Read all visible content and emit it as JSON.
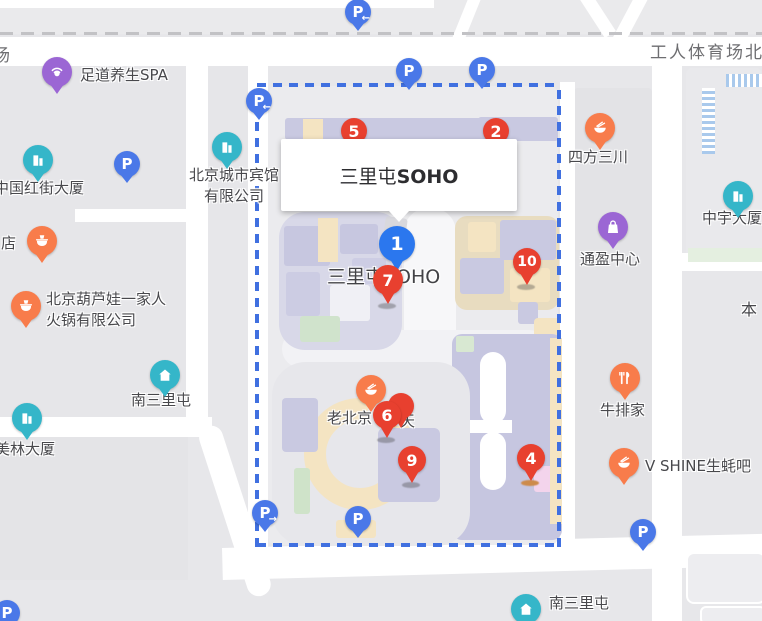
{
  "card": {
    "title_cjk": "三里屯",
    "title_latin": "SOHO"
  },
  "boundary": {
    "style": "dashed",
    "color": "#4070e0"
  },
  "map_text_labels": [
    {
      "id": "map-label-sanlitun-soho",
      "text": "三里屯SOHO",
      "x": 327,
      "y": 266,
      "size": 19,
      "color": "#434347"
    },
    {
      "id": "road-label-gongti-north",
      "text": "工人体育场北",
      "x": 650,
      "y": 43,
      "size": 17,
      "color": "#6e6e71",
      "spacing": 2
    },
    {
      "id": "road-label-partial-west",
      "text": "场",
      "x": -7,
      "y": 46,
      "size": 17,
      "color": "#6e6e71"
    },
    {
      "id": "label-partial-ben",
      "text": "本",
      "x": 741,
      "y": 300,
      "size": 16,
      "color": "#48484c"
    },
    {
      "id": "label-fragment-tian",
      "text": "天",
      "x": 400,
      "y": 412,
      "size": 15,
      "color": "#48484c"
    }
  ],
  "numbered_markers": [
    {
      "number": "1",
      "color_key": "blue",
      "x": 397,
      "y": 244,
      "r": 18
    },
    {
      "number": "7",
      "color_key": "red",
      "x": 388,
      "y": 280,
      "r": 15,
      "shadow": true
    },
    {
      "number": "5",
      "color_key": "red",
      "x": 354,
      "y": 131,
      "r": 13
    },
    {
      "number": "2",
      "color_key": "red",
      "x": 496,
      "y": 131,
      "r": 13
    },
    {
      "number": "10",
      "color_key": "red",
      "x": 527,
      "y": 262,
      "r": 14,
      "shadow": true
    },
    {
      "number": "",
      "color_key": "red",
      "x": 401,
      "y": 406,
      "r": 13
    },
    {
      "number": "6",
      "color_key": "red",
      "x": 387,
      "y": 415,
      "r": 14,
      "shadow": true
    },
    {
      "number": "9",
      "color_key": "red",
      "x": 412,
      "y": 460,
      "r": 14,
      "shadow": true
    },
    {
      "number": "4",
      "color_key": "red",
      "x": 531,
      "y": 458,
      "r": 14,
      "shadow": true,
      "shadow_color": "#cd8b4b"
    }
  ],
  "parking_markers": [
    {
      "x": 358,
      "y": 12,
      "variant": "arrow-left"
    },
    {
      "x": 409,
      "y": 71,
      "variant": "plain"
    },
    {
      "x": 482,
      "y": 70,
      "variant": "plain"
    },
    {
      "x": 259,
      "y": 101,
      "variant": "arrow-left"
    },
    {
      "x": 127,
      "y": 164,
      "variant": "plain"
    },
    {
      "x": 265,
      "y": 513,
      "variant": "arrow-right"
    },
    {
      "x": 358,
      "y": 519,
      "variant": "plain"
    },
    {
      "x": 643,
      "y": 532,
      "variant": "plain"
    },
    {
      "x": 7,
      "y": 613,
      "variant": "plain"
    }
  ],
  "pois": [
    {
      "id": "zudao-yangsheng-spa",
      "icon": "spa-icon",
      "pin_color_key": "purple",
      "x": 57,
      "y": 72,
      "label": {
        "lines": [
          "足道养生SPA"
        ],
        "x": 80,
        "y": 65,
        "align": "left"
      }
    },
    {
      "id": "zhongguo-hongjie-daxia",
      "icon": "building-icon",
      "pin_color_key": "teal",
      "x": 38,
      "y": 160,
      "label": {
        "lines": [
          "中国红街大厦"
        ],
        "x": -6,
        "y": 178,
        "align": "left"
      }
    },
    {
      "id": "beijing-city-hotel",
      "icon": "building-icon",
      "pin_color_key": "teal",
      "x": 227,
      "y": 147,
      "label": {
        "lines": [
          "北京城市宾馆",
          "有限公司"
        ],
        "x": 234,
        "y": 165,
        "align": "center"
      }
    },
    {
      "id": "partial-dian",
      "icon": "hotpot-icon",
      "pin_color_key": "orange",
      "x": 42,
      "y": 241,
      "label": {
        "lines": [
          "店"
        ],
        "x": 1,
        "y": 233,
        "align": "left"
      }
    },
    {
      "id": "huluwa-hotpot",
      "icon": "hotpot-icon",
      "pin_color_key": "orange",
      "x": 26,
      "y": 306,
      "label": {
        "lines": [
          "北京葫芦娃一家人",
          "火锅有限公司"
        ],
        "x": 46,
        "y": 289,
        "align": "left"
      }
    },
    {
      "id": "sifang-sanchuan",
      "icon": "bowl-icon",
      "pin_color_key": "orange",
      "x": 600,
      "y": 128,
      "label": {
        "lines": [
          "四方三川"
        ],
        "x": 568,
        "y": 147,
        "align": "left"
      }
    },
    {
      "id": "tongying-center",
      "icon": "shopping-bag-icon",
      "pin_color_key": "purple",
      "x": 613,
      "y": 227,
      "label": {
        "lines": [
          "通盈中心"
        ],
        "x": 580,
        "y": 249,
        "align": "left"
      }
    },
    {
      "id": "zhongyu-daxia",
      "icon": "building-icon",
      "pin_color_key": "teal",
      "x": 738,
      "y": 196,
      "label": {
        "lines": [
          "中宇大厦"
        ],
        "x": 702,
        "y": 208,
        "align": "left"
      }
    },
    {
      "id": "nansanlitun-mid",
      "icon": "house-icon",
      "pin_color_key": "teal",
      "x": 165,
      "y": 375,
      "label": {
        "lines": [
          "南三里屯"
        ],
        "x": 131,
        "y": 390,
        "align": "left"
      }
    },
    {
      "id": "meilin-daxia",
      "icon": "building-icon",
      "pin_color_key": "teal",
      "x": 27,
      "y": 418,
      "label": {
        "lines": [
          "美林大厦"
        ],
        "x": -5,
        "y": 439,
        "align": "left"
      }
    },
    {
      "id": "laobeijing",
      "icon": "bowl-icon",
      "pin_color_key": "orange",
      "x": 371,
      "y": 390,
      "label": {
        "lines": [
          "老北京"
        ],
        "x": 327,
        "y": 408,
        "align": "left"
      }
    },
    {
      "id": "niupaijia",
      "icon": "fork-knife-icon",
      "pin_color_key": "orange",
      "x": 625,
      "y": 378,
      "label": {
        "lines": [
          "牛排家"
        ],
        "x": 600,
        "y": 400,
        "align": "left"
      }
    },
    {
      "id": "vshine-oyster-bar",
      "icon": "bowl-icon",
      "pin_color_key": "orange",
      "x": 624,
      "y": 463,
      "label": {
        "lines": [
          "V SHINE生蚝吧"
        ],
        "x": 645,
        "y": 456,
        "align": "left"
      }
    },
    {
      "id": "nansanlitun-south",
      "icon": "house-icon",
      "pin_color_key": "teal",
      "x": 526,
      "y": 609,
      "label": {
        "lines": [
          "南三里屯"
        ],
        "x": 549,
        "y": 593,
        "align": "left"
      }
    }
  ],
  "colors": {
    "red": "#e8402f",
    "blue": "#2b77ee",
    "parking": "#4a78e8",
    "teal": "#35b6c9",
    "orange": "#f87c4b",
    "purple": "#9b66d4",
    "boundary": "#4070e0",
    "label_gray": "#48484c",
    "building_purple": "#c9c9e1",
    "building_tan": "#f4e4c2",
    "road_white": "#ffffff",
    "card_bg": "#ffffff"
  }
}
